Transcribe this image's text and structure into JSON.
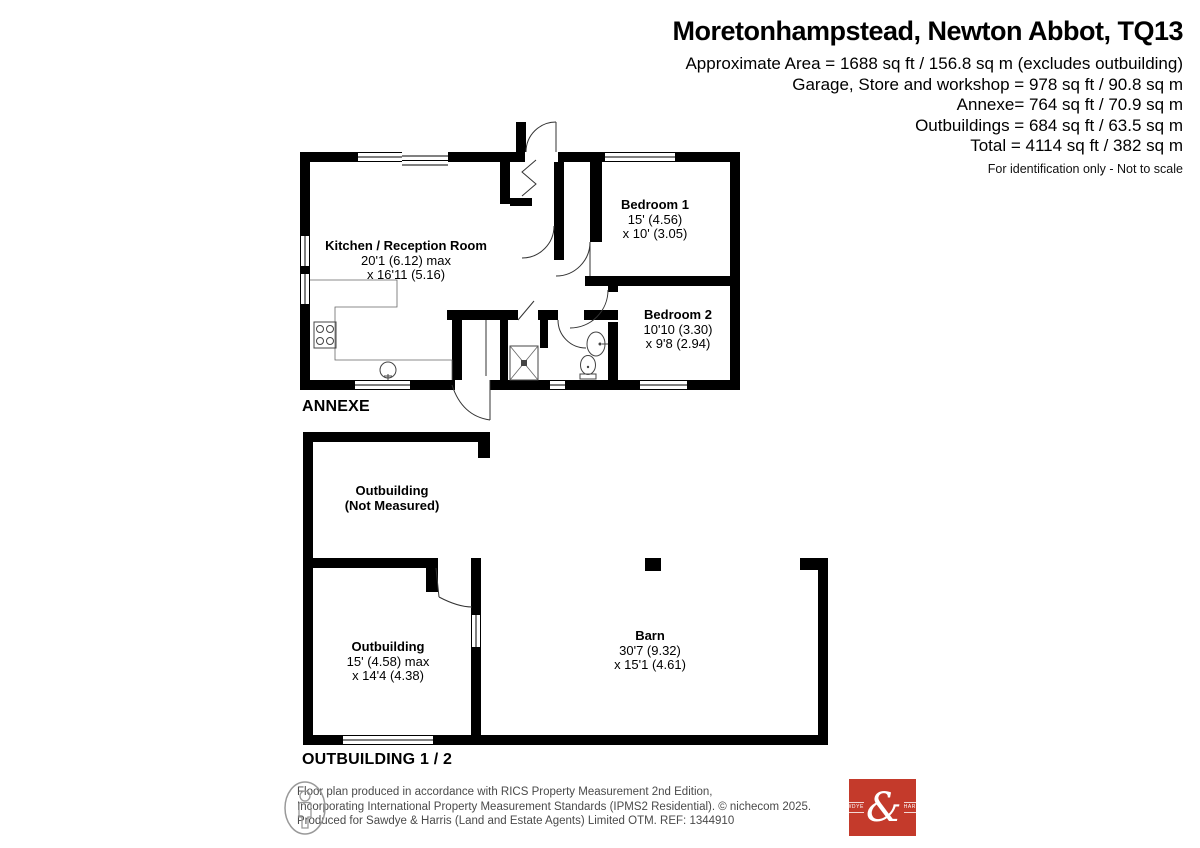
{
  "header": {
    "title": "Moretonhampstead, Newton Abbot, TQ13",
    "area_lines": [
      "Approximate Area = 1688 sq ft / 156.8 sq m (excludes outbuilding)",
      "Garage, Store and workshop = 978 sq ft / 90.8 sq m",
      "Annexe= 764 sq ft / 70.9 sq m",
      "Outbuildings = 684 sq ft / 63.5 sq m",
      "Total = 4114 sq ft / 382 sq m"
    ],
    "disclaimer": "For identification only - Not to scale"
  },
  "annexe": {
    "label": "ANNEXE",
    "rooms": {
      "kitchen": {
        "name": "Kitchen / Reception Room",
        "dim1": "20'1 (6.12) max",
        "dim2": "x 16'11 (5.16)"
      },
      "bedroom1": {
        "name": "Bedroom 1",
        "dim1": "15' (4.56)",
        "dim2": "x 10' (3.05)"
      },
      "bedroom2": {
        "name": "Bedroom 2",
        "dim1": "10'10 (3.30)",
        "dim2": "x 9'8 (2.94)"
      }
    }
  },
  "outbuildings": {
    "label": "OUTBUILDING 1 / 2",
    "rooms": {
      "outbuilding_top": {
        "name": "Outbuilding",
        "dim1": "(Not Measured)"
      },
      "outbuilding_left": {
        "name": "Outbuilding",
        "dim1": "15' (4.58) max",
        "dim2": "x 14'4 (4.38)"
      },
      "barn": {
        "name": "Barn",
        "dim1": "30'7 (9.32)",
        "dim2": "x 15'1 (4.61)"
      }
    }
  },
  "footer": {
    "line1": "Floor plan produced in accordance with RICS Property Measurement 2nd Edition,",
    "line2": "Incorporating International Property Measurement Standards (IPMS2 Residential).   © nichecom 2025.",
    "line3": "Produced for Sawdye & Harris (Land and Estate Agents) Limited OTM.   REF: 1344910",
    "logo": {
      "left": "SAWDYE",
      "ampersand": "&",
      "right": "HARRIS",
      "color": "#c43a2b"
    }
  },
  "colors": {
    "wall": "#000000",
    "logo_red": "#c43a2b",
    "footer_text": "#4a4a4a"
  }
}
